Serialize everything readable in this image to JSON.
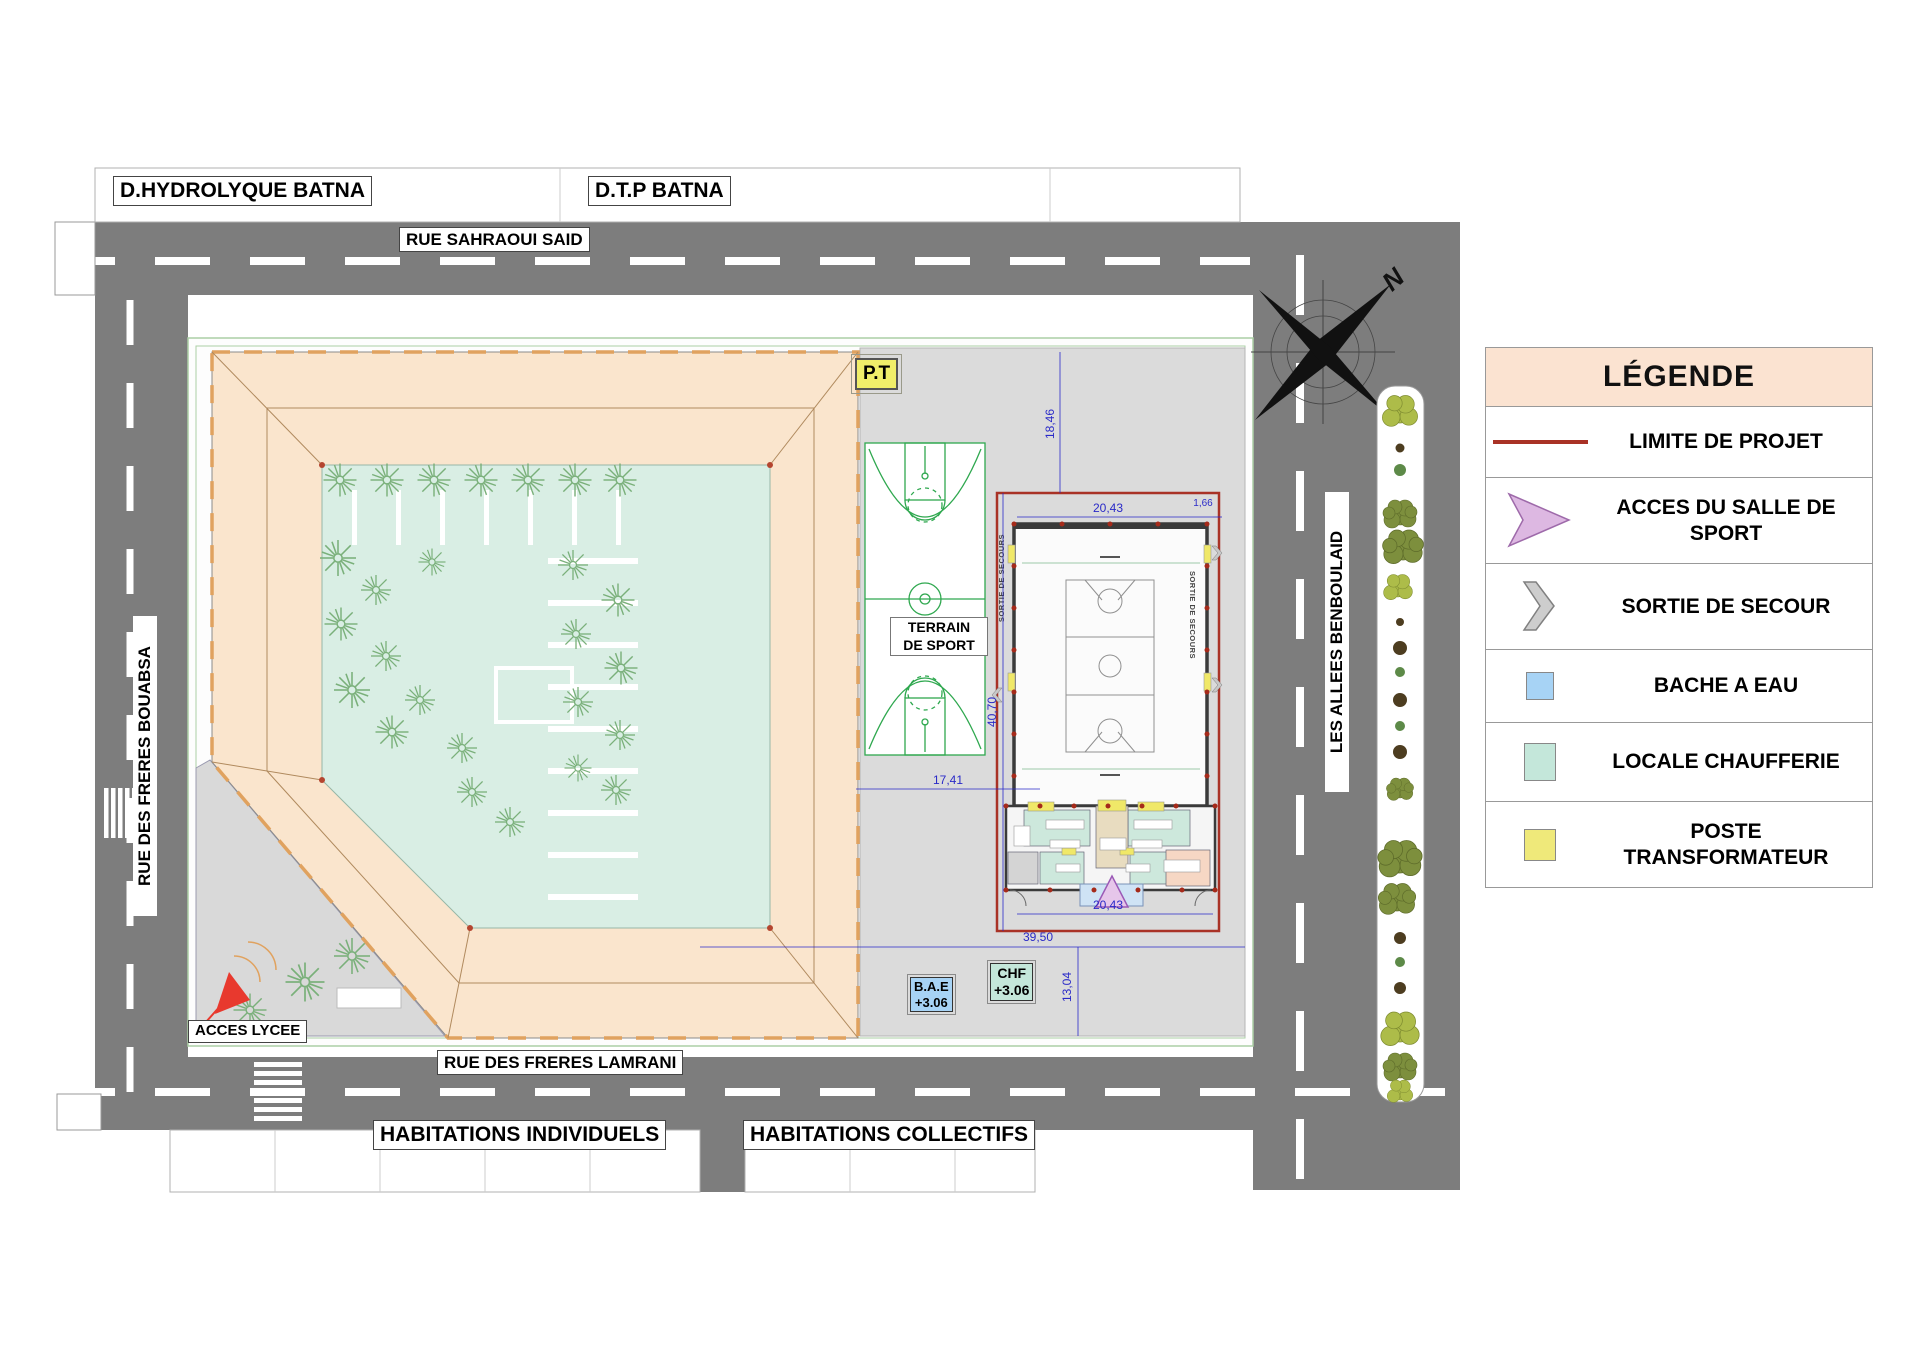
{
  "streets": {
    "north": "RUE SAHRAOUI SAID",
    "west": "RUE DES FRERES BOUABSA",
    "south": "RUE DES FRERES LAMRANI",
    "east": "LES ALLEES BENBOULAID"
  },
  "parcels": {
    "hydrolyque": "D.HYDROLYQUE BATNA",
    "dtp": "D.T.P BATNA",
    "individuels": "HABITATIONS INDIVIDUELS",
    "collectifs": "HABITATIONS COLLECTIFS"
  },
  "site": {
    "acces_lycee": "ACCES LYCEE",
    "terrain_de_sport": "TERRAIN DE SPORT",
    "poste_transformateur_tag": "P.T",
    "sortie_de_secours": "SORTIE DE SECOURS",
    "bache_a_eau": {
      "tag": "B.A.E",
      "level": "+3.06"
    },
    "chaufferie": {
      "tag": "CHF",
      "level": "+3.06"
    }
  },
  "compass": {
    "north_letter": "N"
  },
  "dimensions": {
    "d1846": "18,46",
    "d2043": "20,43",
    "d166": "1,66",
    "d4070": "40,70",
    "d1741": "17,41",
    "d3950": "39,50",
    "d1304": "13,04"
  },
  "legend": {
    "title": "LÉGENDE",
    "items": [
      {
        "label": "LIMITE DE PROJET",
        "symbol": "project-limit-line",
        "color": "#a93226"
      },
      {
        "label": "ACCES DU SALLE DE SPORT",
        "symbol": "access-arrow",
        "color": "#ddb8e2"
      },
      {
        "label": "SORTIE DE SECOUR",
        "symbol": "emergency-exit-chevron",
        "color": "#cdcdcd"
      },
      {
        "label": "BACHE A EAU",
        "symbol": "water-tank-square",
        "color": "#a7d3f5"
      },
      {
        "label": "LOCALE CHAUFFERIE",
        "symbol": "boiler-room-square",
        "color": "#c4e7da"
      },
      {
        "label": "POSTE TRANSFORMATEUR",
        "symbol": "transformer-square",
        "color": "#efe97a"
      }
    ]
  }
}
